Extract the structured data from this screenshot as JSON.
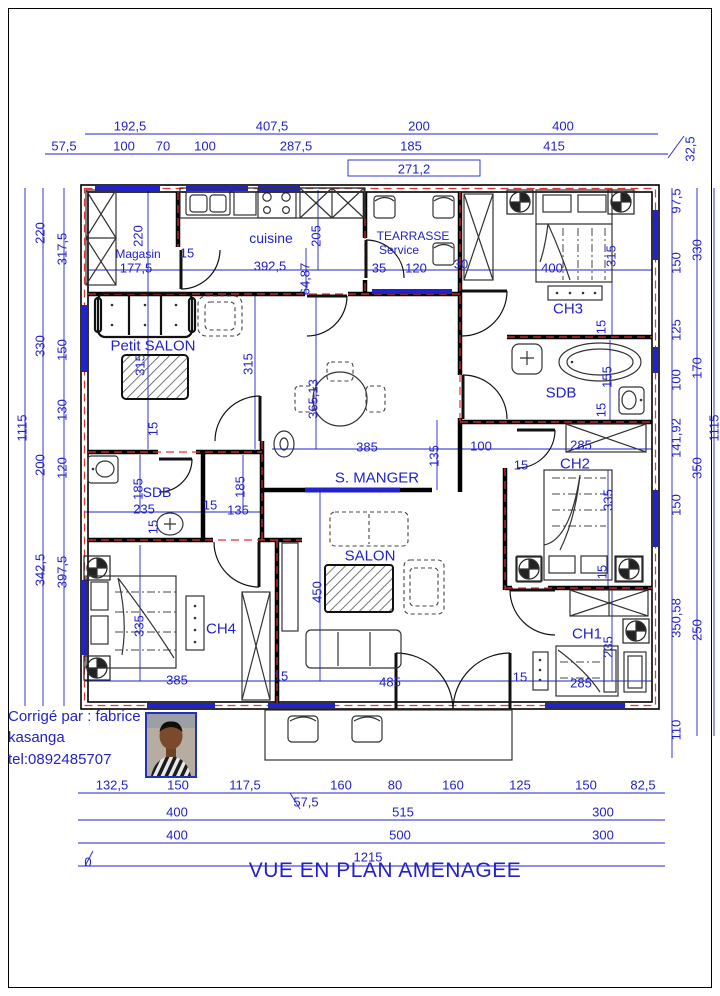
{
  "title": "VUE EN PLAN AMENAGEE",
  "credit": {
    "line1": "Corrigé par : fabrice",
    "line2": "kasanga",
    "line3": "tel:0892485707"
  },
  "colors": {
    "dim": "#2222cc",
    "red": "#e03535",
    "window": "#2222cc",
    "wall": "#000000"
  },
  "rooms": [
    {
      "t": "Magasin",
      "x": 138,
      "y": 254,
      "fs": 12
    },
    {
      "t": "cuisine",
      "x": 271,
      "y": 238,
      "fs": 14
    },
    {
      "t": "TEARRASSE",
      "x": 413,
      "y": 236,
      "fs": 12
    },
    {
      "t": "Service",
      "x": 399,
      "y": 250,
      "fs": 12
    },
    {
      "t": "CH3",
      "x": 568,
      "y": 309,
      "fs": 15
    },
    {
      "t": "SDB",
      "x": 561,
      "y": 393,
      "fs": 15
    },
    {
      "t": "CH2",
      "x": 575,
      "y": 464,
      "fs": 15
    },
    {
      "t": "Petit SALON",
      "x": 153,
      "y": 346,
      "fs": 15
    },
    {
      "t": "SDB",
      "x": 157,
      "y": 492,
      "fs": 14
    },
    {
      "t": "S. MANGER",
      "x": 377,
      "y": 478,
      "fs": 15
    },
    {
      "t": "SALON",
      "x": 370,
      "y": 556,
      "fs": 15
    },
    {
      "t": "CH4",
      "x": 221,
      "y": 629,
      "fs": 15
    },
    {
      "t": "CH1",
      "x": 587,
      "y": 634,
      "fs": 15
    }
  ],
  "dims": [
    {
      "t": "192,5",
      "x": 130,
      "y": 126
    },
    {
      "t": "407,5",
      "x": 272,
      "y": 126
    },
    {
      "t": "200",
      "x": 419,
      "y": 126
    },
    {
      "t": "400",
      "x": 563,
      "y": 126
    },
    {
      "t": "57,5",
      "x": 64,
      "y": 146
    },
    {
      "t": "100",
      "x": 124,
      "y": 146
    },
    {
      "t": "70",
      "x": 163,
      "y": 146
    },
    {
      "t": "100",
      "x": 205,
      "y": 146
    },
    {
      "t": "287,5",
      "x": 296,
      "y": 146
    },
    {
      "t": "185",
      "x": 411,
      "y": 146
    },
    {
      "t": "415",
      "x": 554,
      "y": 146
    },
    {
      "t": "32,5",
      "x": 690,
      "y": 149,
      "r": 1
    },
    {
      "t": "271,2",
      "x": 414,
      "y": 169
    },
    {
      "t": "1115",
      "x": 22,
      "y": 428,
      "r": 1
    },
    {
      "t": "220",
      "x": 40,
      "y": 233,
      "r": 1
    },
    {
      "t": "330",
      "x": 40,
      "y": 346,
      "r": 1
    },
    {
      "t": "200",
      "x": 40,
      "y": 465,
      "r": 1
    },
    {
      "t": "342,5",
      "x": 40,
      "y": 570,
      "r": 1
    },
    {
      "t": "317,5",
      "x": 62,
      "y": 249,
      "r": 1
    },
    {
      "t": "150",
      "x": 62,
      "y": 350,
      "r": 1
    },
    {
      "t": "130",
      "x": 62,
      "y": 410,
      "r": 1
    },
    {
      "t": "120",
      "x": 62,
      "y": 468,
      "r": 1
    },
    {
      "t": "397,5",
      "x": 62,
      "y": 572,
      "r": 1
    },
    {
      "t": "97,5",
      "x": 676,
      "y": 201,
      "r": 1
    },
    {
      "t": "150",
      "x": 676,
      "y": 263,
      "r": 1
    },
    {
      "t": "125",
      "x": 676,
      "y": 330,
      "r": 1
    },
    {
      "t": "100",
      "x": 676,
      "y": 380,
      "r": 1
    },
    {
      "t": "141,92",
      "x": 676,
      "y": 438,
      "r": 1
    },
    {
      "t": "150",
      "x": 676,
      "y": 505,
      "r": 1
    },
    {
      "t": "350,58",
      "x": 676,
      "y": 618,
      "r": 1
    },
    {
      "t": "110",
      "x": 676,
      "y": 730,
      "r": 1
    },
    {
      "t": "330",
      "x": 697,
      "y": 250,
      "r": 1
    },
    {
      "t": "170",
      "x": 697,
      "y": 368,
      "r": 1
    },
    {
      "t": "350",
      "x": 697,
      "y": 468,
      "r": 1
    },
    {
      "t": "250",
      "x": 697,
      "y": 630,
      "r": 1
    },
    {
      "t": "1115",
      "x": 714,
      "y": 428,
      "r": 1
    },
    {
      "t": "132,5",
      "x": 112,
      "y": 785
    },
    {
      "t": "150",
      "x": 178,
      "y": 785
    },
    {
      "t": "117,5",
      "x": 245,
      "y": 785
    },
    {
      "t": "160",
      "x": 341,
      "y": 785
    },
    {
      "t": "80",
      "x": 395,
      "y": 785
    },
    {
      "t": "160",
      "x": 453,
      "y": 785
    },
    {
      "t": "125",
      "x": 520,
      "y": 785
    },
    {
      "t": "150",
      "x": 586,
      "y": 785
    },
    {
      "t": "82,5",
      "x": 643,
      "y": 785
    },
    {
      "t": "57,5",
      "x": 306,
      "y": 802
    },
    {
      "t": "400",
      "x": 177,
      "y": 812
    },
    {
      "t": "515",
      "x": 403,
      "y": 812
    },
    {
      "t": "300",
      "x": 603,
      "y": 812
    },
    {
      "t": "400",
      "x": 177,
      "y": 835
    },
    {
      "t": "500",
      "x": 400,
      "y": 835
    },
    {
      "t": "300",
      "x": 603,
      "y": 835
    },
    {
      "t": "1215",
      "x": 368,
      "y": 857
    },
    {
      "t": "0",
      "x": 88,
      "y": 862
    },
    {
      "t": "220",
      "x": 138,
      "y": 236,
      "r": 1
    },
    {
      "t": "15",
      "x": 187,
      "y": 253
    },
    {
      "t": "392,5",
      "x": 270,
      "y": 266
    },
    {
      "t": "205",
      "x": 316,
      "y": 236,
      "r": 1
    },
    {
      "t": "64,87",
      "x": 305,
      "y": 279,
      "r": 1
    },
    {
      "t": "177,5",
      "x": 136,
      "y": 268
    },
    {
      "t": "35",
      "x": 379,
      "y": 268
    },
    {
      "t": "120",
      "x": 416,
      "y": 268
    },
    {
      "t": "30",
      "x": 461,
      "y": 264
    },
    {
      "t": "400",
      "x": 552,
      "y": 268
    },
    {
      "t": "315",
      "x": 611,
      "y": 256,
      "r": 1
    },
    {
      "t": "15",
      "x": 601,
      "y": 327,
      "r": 1
    },
    {
      "t": "155",
      "x": 607,
      "y": 377,
      "r": 1
    },
    {
      "t": "15",
      "x": 601,
      "y": 410,
      "r": 1
    },
    {
      "t": "315",
      "x": 140,
      "y": 365,
      "r": 1
    },
    {
      "t": "315",
      "x": 248,
      "y": 364,
      "r": 1
    },
    {
      "t": "15",
      "x": 153,
      "y": 429,
      "r": 1
    },
    {
      "t": "365,13",
      "x": 313,
      "y": 399,
      "r": 1
    },
    {
      "t": "385",
      "x": 367,
      "y": 447
    },
    {
      "t": "135",
      "x": 434,
      "y": 456,
      "r": 1
    },
    {
      "t": "100",
      "x": 481,
      "y": 446
    },
    {
      "t": "15",
      "x": 521,
      "y": 465
    },
    {
      "t": "285",
      "x": 581,
      "y": 445
    },
    {
      "t": "185",
      "x": 138,
      "y": 489,
      "r": 1
    },
    {
      "t": "185",
      "x": 240,
      "y": 487,
      "r": 1
    },
    {
      "t": "235",
      "x": 144,
      "y": 509
    },
    {
      "t": "15",
      "x": 210,
      "y": 505
    },
    {
      "t": "135",
      "x": 238,
      "y": 510
    },
    {
      "t": "15",
      "x": 153,
      "y": 527,
      "r": 1
    },
    {
      "t": "335",
      "x": 139,
      "y": 626,
      "r": 1
    },
    {
      "t": "450",
      "x": 317,
      "y": 592,
      "r": 1
    },
    {
      "t": "385",
      "x": 177,
      "y": 680
    },
    {
      "t": "15",
      "x": 281,
      "y": 676
    },
    {
      "t": "485",
      "x": 390,
      "y": 682
    },
    {
      "t": "15",
      "x": 520,
      "y": 677
    },
    {
      "t": "285",
      "x": 581,
      "y": 683
    },
    {
      "t": "335",
      "x": 608,
      "y": 500,
      "r": 1
    },
    {
      "t": "15",
      "x": 602,
      "y": 572,
      "r": 1
    },
    {
      "t": "235",
      "x": 608,
      "y": 647,
      "r": 1
    }
  ]
}
